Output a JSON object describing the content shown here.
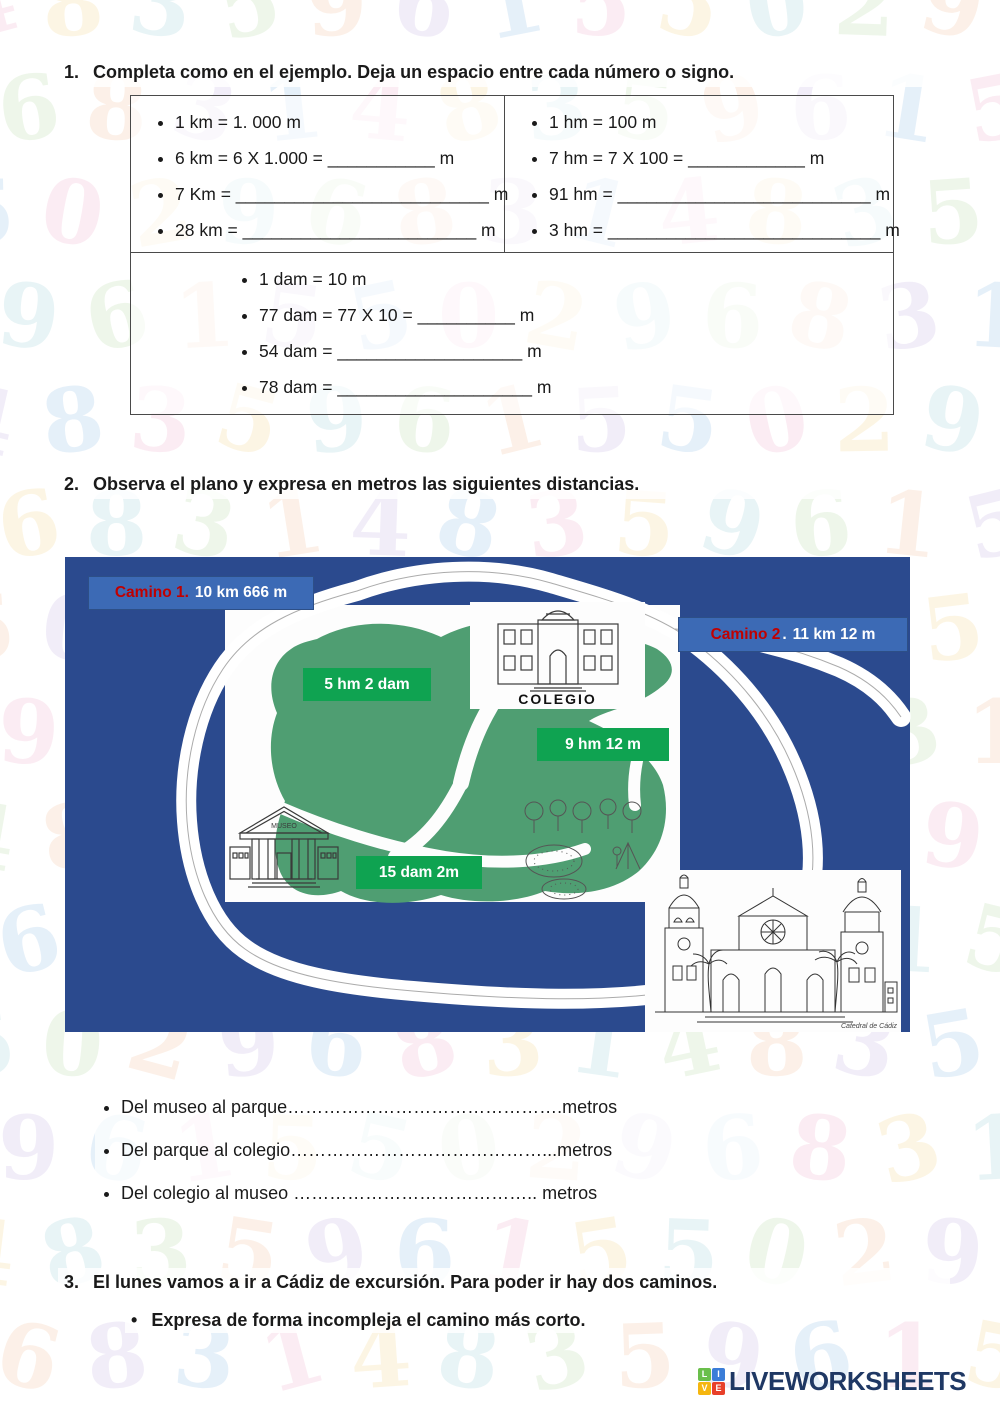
{
  "colors": {
    "ink": "#1a1a1a",
    "map_bg": "#2b4a8e",
    "camino_panel": "#3c6ab5",
    "camino_red": "#c00000",
    "island": "#4f9e72",
    "green_label": "#0fa351",
    "navy": "#1f3864"
  },
  "decor": {
    "digits": "4835961550296831",
    "colors": [
      "#f3b8d2",
      "#f7dc9a",
      "#a9d7dd",
      "#bfe0b0",
      "#f5c9a8",
      "#cdbce8",
      "#9fc6ea"
    ]
  },
  "exercise1": {
    "number": "1.",
    "title": "Completa como en el ejemplo. Deja un espacio entre cada número o signo.",
    "col_left": [
      "1 km = 1. 000 m",
      "6 km = 6 X 1.000 = ___________  m",
      "7 Km = __________________________ m",
      "28 km = ________________________ m"
    ],
    "col_right": [
      "1 hm = 100 m",
      "7 hm = 7 X 100 = ____________ m",
      "91 hm = __________________________ m",
      "3 hm = ____________________________ m"
    ],
    "row2": [
      "1 dam = 10 m",
      "77 dam = 77 X 10 = __________ m",
      "54 dam = ___________________ m",
      "78 dam = ____________________ m"
    ]
  },
  "exercise2": {
    "number": "2.",
    "title": "Observa el plano y expresa en metros las siguientes distancias.",
    "map": {
      "camino1_name": "Camino 1.",
      "camino1_value": "10 km 666 m",
      "camino2_name": "Camino 2",
      "camino2_sep": ".",
      "camino2_value": "11 km 12 m",
      "dist1": "5 hm 2 dam",
      "dist2": "9 hm 12 m",
      "dist3": "15 dam 2m",
      "school_caption": "COLEGIO",
      "museum_caption": "MUSEO",
      "cathedral_caption": "Catedral de Cádiz"
    },
    "questions": [
      "Del museo al parque……………………………………….metros",
      "Del parque al colegio……………………………………...metros",
      "Del colegio al museo ………………………………….. metros"
    ]
  },
  "exercise3": {
    "number": "3.",
    "title": "El lunes vamos a ir a Cádiz de excursión. Para poder ir hay dos caminos.",
    "bullet_dot": "•",
    "bullet": "Expresa de forma incompleja el camino más corto."
  },
  "footer": {
    "brand": "LIVEWORKSHEETS",
    "tiles": [
      "L",
      "I",
      "V",
      "E"
    ],
    "tile_colors": [
      "#6abf4b",
      "#3b7dd8",
      "#f5b60f",
      "#e8402a"
    ]
  }
}
